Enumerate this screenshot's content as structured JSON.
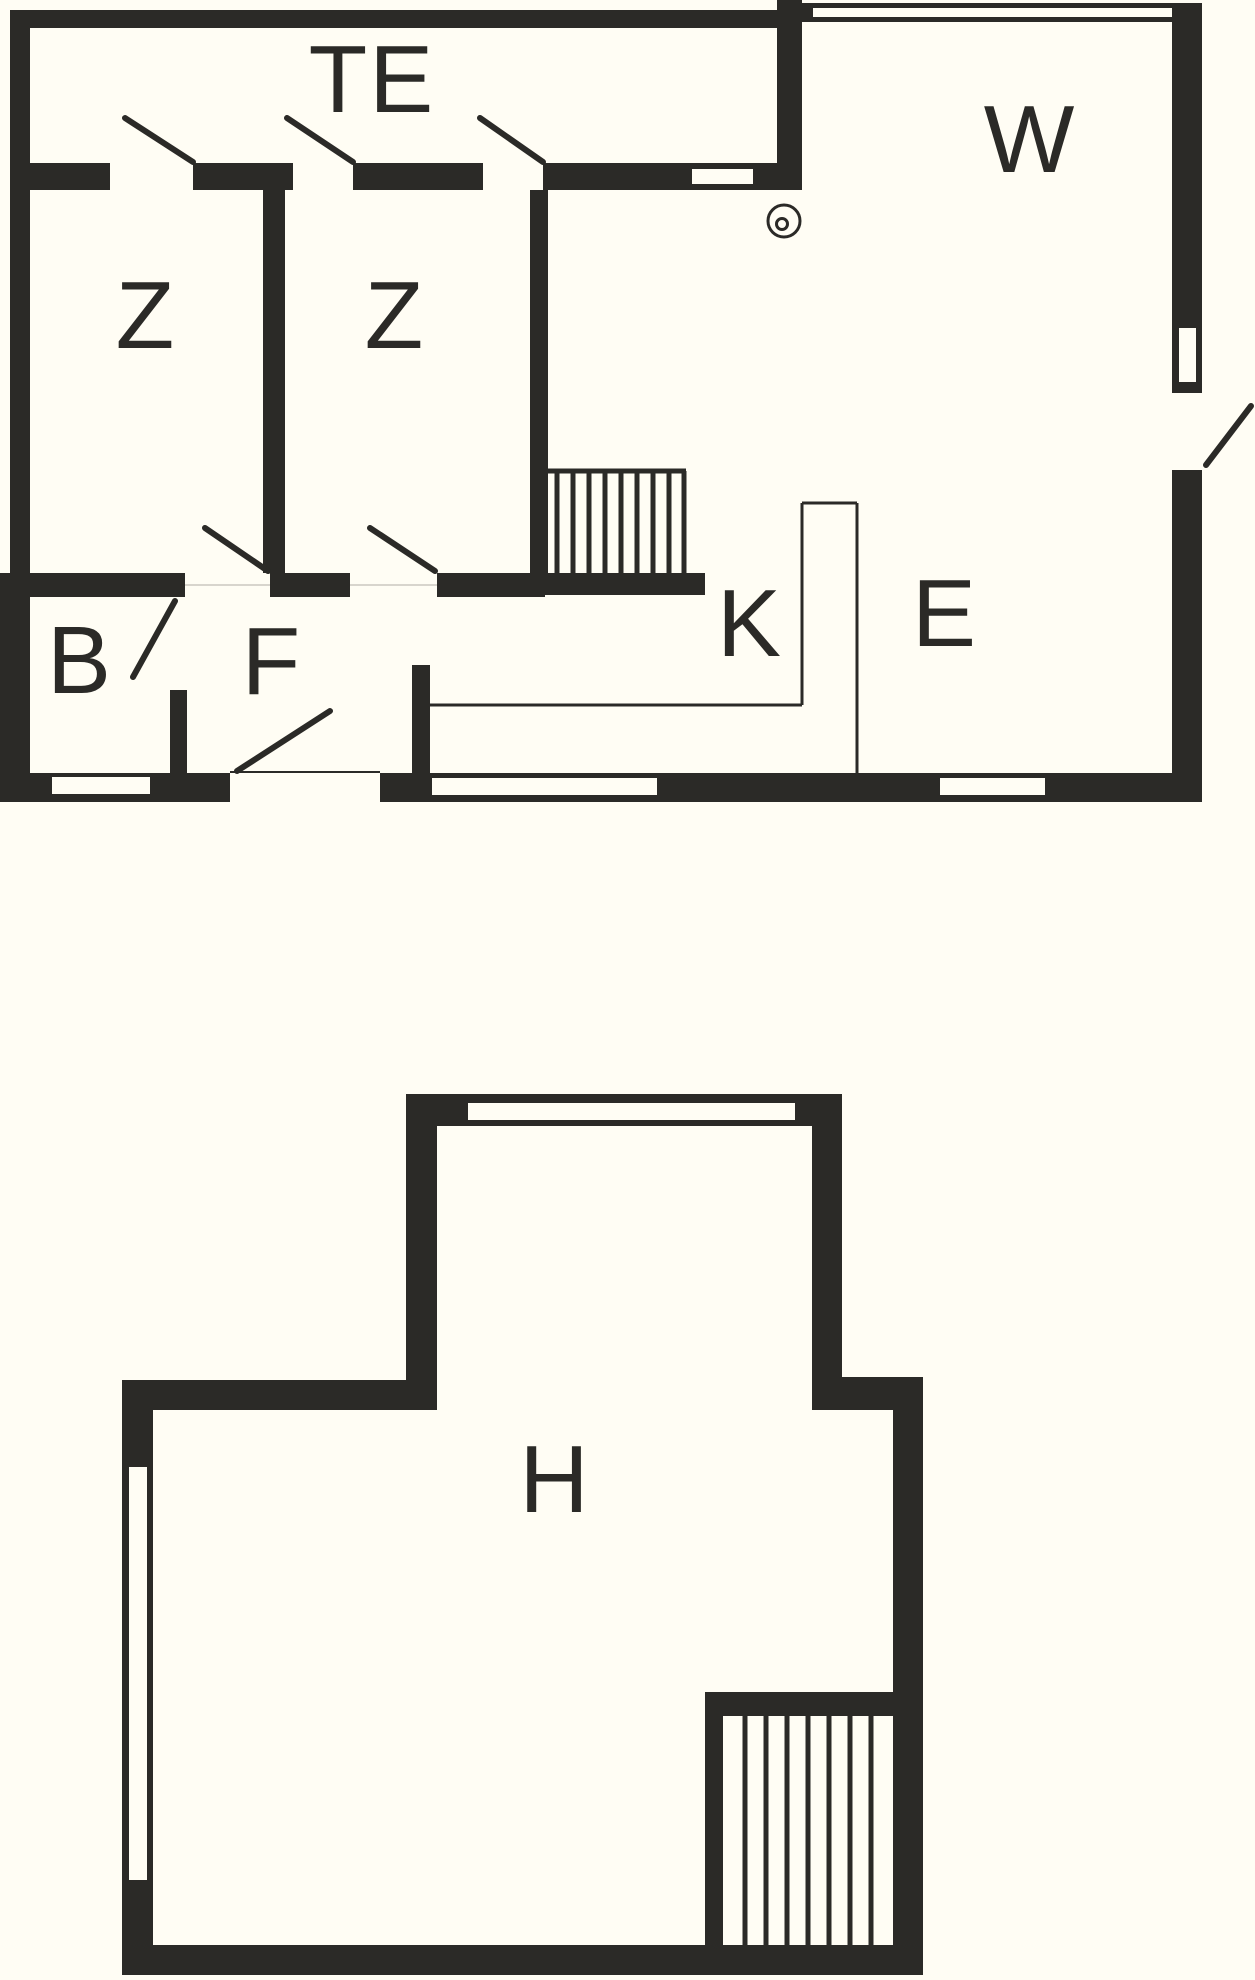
{
  "colors": {
    "ink": "#2b2a27",
    "background": "#fffdf4"
  },
  "floors": {
    "upper": {
      "rooms": [
        {
          "id": "te",
          "label": "TE"
        },
        {
          "id": "w",
          "label": "W"
        },
        {
          "id": "z1",
          "label": "Z"
        },
        {
          "id": "z2",
          "label": "Z"
        },
        {
          "id": "b",
          "label": "B"
        },
        {
          "id": "f",
          "label": "F"
        },
        {
          "id": "k",
          "label": "K"
        },
        {
          "id": "e",
          "label": "E"
        }
      ],
      "features": [
        "stairs",
        "stove",
        "kitchen-counter",
        "windows",
        "door-swings"
      ]
    },
    "lower": {
      "rooms": [
        {
          "id": "h",
          "label": "H"
        }
      ],
      "features": [
        "stairs",
        "windows"
      ]
    }
  }
}
